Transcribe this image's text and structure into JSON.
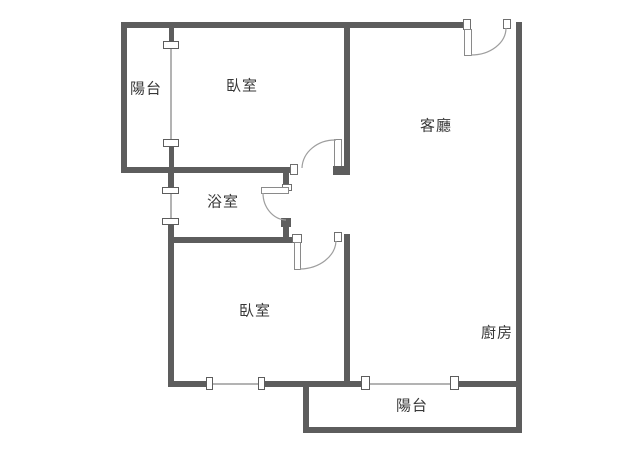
{
  "title": "apartment-floor-plan",
  "rooms": {
    "balcony_top": {
      "label": "陽台"
    },
    "bedroom_top": {
      "label": "臥室"
    },
    "living_room": {
      "label": "客廳"
    },
    "bathroom": {
      "label": "浴室"
    },
    "bedroom_bottom": {
      "label": "臥室"
    },
    "kitchen": {
      "label": "廚房"
    },
    "balcony_bottom": {
      "label": "陽台"
    }
  },
  "colors": {
    "wall": "#5d5d5d",
    "window_line": "#b3b3b3",
    "door_arc": "#9e9e9e",
    "fixture_border": "#6f6f6f",
    "text": "#383838",
    "background": "#ffffff"
  }
}
